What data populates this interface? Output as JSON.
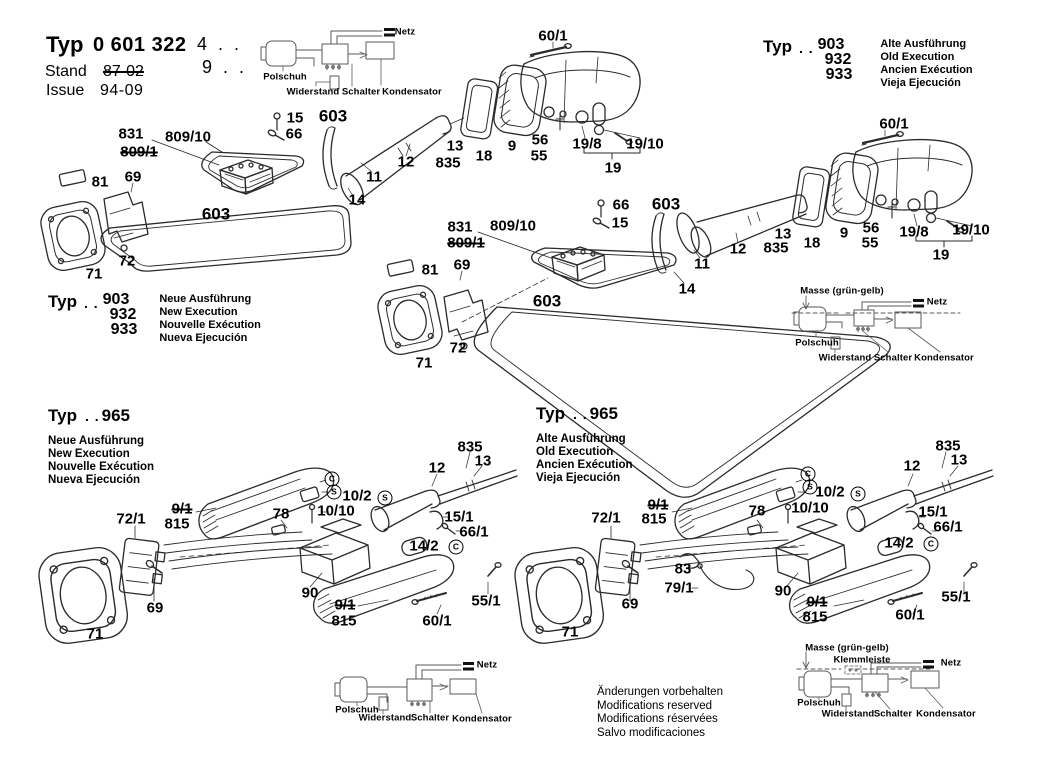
{
  "header": {
    "typ": "Typ",
    "number": "0 601 322",
    "suffix1": "4 . .",
    "suffix2": "9 . .",
    "stand_label": "Stand",
    "stand_value": "87-02",
    "issue_label": "Issue",
    "issue_value": "94-09"
  },
  "type_blocks": [
    {
      "typ": "Typ",
      "dots": ". .",
      "models": [
        "903",
        "932",
        "933"
      ],
      "variants": [
        "Alte Ausführung",
        "Old Execution",
        "Ancien Exécution",
        "Vieja Ejecución"
      ]
    },
    {
      "typ": "Typ",
      "dots": ". .",
      "models": [
        "903",
        "932",
        "933"
      ],
      "variants": [
        "Neue Ausführung",
        "New Execution",
        "Nouvelle Exécution",
        "Nueva Ejecución"
      ]
    },
    {
      "typ": "Typ",
      "dots": ". .",
      "models": [
        "965"
      ],
      "variants": [
        "Neue Ausführung",
        "New Execution",
        "Nouvelle Exécution",
        "Nueva Ejecución"
      ]
    },
    {
      "typ": "Typ",
      "dots": ". .",
      "models": [
        "965"
      ],
      "variants": [
        "Alte Ausführung",
        "Old Execution",
        "Ancien Exécution",
        "Vieja Ejecución"
      ]
    }
  ],
  "footer": {
    "lines": [
      "Änderungen vorbehalten",
      "Modifications reserved",
      "Modifications réservées",
      "Salvo modificaciones"
    ]
  },
  "colors": {
    "ink": "#000000",
    "line": "#2a2a2a",
    "schematic": "#5a5a5a",
    "paper": "#ffffff"
  },
  "labels": [
    {
      "t": "831",
      "x": 131,
      "y": 134
    },
    {
      "t": "809/1",
      "x": 139,
      "y": 152,
      "strike": 1
    },
    {
      "t": "809/10",
      "x": 188,
      "y": 137
    },
    {
      "t": "15",
      "x": 295,
      "y": 118
    },
    {
      "t": "66",
      "x": 294,
      "y": 134
    },
    {
      "t": "603",
      "x": 333,
      "y": 116,
      "lg": 1
    },
    {
      "t": "81",
      "x": 100,
      "y": 182
    },
    {
      "t": "69",
      "x": 133,
      "y": 177
    },
    {
      "t": "603",
      "x": 216,
      "y": 214,
      "lg": 1
    },
    {
      "t": "72",
      "x": 127,
      "y": 261
    },
    {
      "t": "71",
      "x": 94,
      "y": 274
    },
    {
      "t": "11",
      "x": 374,
      "y": 177
    },
    {
      "t": "14",
      "x": 357,
      "y": 200
    },
    {
      "t": "12",
      "x": 406,
      "y": 162
    },
    {
      "t": "13",
      "x": 455,
      "y": 146
    },
    {
      "t": "835",
      "x": 448,
      "y": 163
    },
    {
      "t": "18",
      "x": 484,
      "y": 156
    },
    {
      "t": "9",
      "x": 512,
      "y": 146
    },
    {
      "t": "56",
      "x": 540,
      "y": 140
    },
    {
      "t": "55",
      "x": 539,
      "y": 156
    },
    {
      "t": "19/8",
      "x": 587,
      "y": 144
    },
    {
      "t": "19/10",
      "x": 645,
      "y": 144
    },
    {
      "t": "19",
      "x": 613,
      "y": 168
    },
    {
      "t": "60/1",
      "x": 553,
      "y": 36
    },
    {
      "t": "66",
      "x": 621,
      "y": 205
    },
    {
      "t": "15",
      "x": 620,
      "y": 223
    },
    {
      "t": "603",
      "x": 666,
      "y": 204,
      "lg": 1
    },
    {
      "t": "831",
      "x": 460,
      "y": 227
    },
    {
      "t": "809/1",
      "x": 466,
      "y": 243,
      "strike": 1
    },
    {
      "t": "809/10",
      "x": 513,
      "y": 226
    },
    {
      "t": "81",
      "x": 430,
      "y": 270
    },
    {
      "t": "69",
      "x": 462,
      "y": 265
    },
    {
      "t": "603",
      "x": 547,
      "y": 301,
      "lg": 1
    },
    {
      "t": "72",
      "x": 458,
      "y": 348
    },
    {
      "t": "71",
      "x": 424,
      "y": 363
    },
    {
      "t": "11",
      "x": 702,
      "y": 264
    },
    {
      "t": "14",
      "x": 687,
      "y": 289
    },
    {
      "t": "12",
      "x": 738,
      "y": 249
    },
    {
      "t": "13",
      "x": 783,
      "y": 234
    },
    {
      "t": "835",
      "x": 776,
      "y": 248
    },
    {
      "t": "18",
      "x": 812,
      "y": 243
    },
    {
      "t": "9",
      "x": 844,
      "y": 233
    },
    {
      "t": "56",
      "x": 871,
      "y": 228
    },
    {
      "t": "55",
      "x": 870,
      "y": 243
    },
    {
      "t": "19/8",
      "x": 914,
      "y": 232
    },
    {
      "t": "19/10",
      "x": 971,
      "y": 230
    },
    {
      "t": "19",
      "x": 941,
      "y": 255
    },
    {
      "t": "60/1",
      "x": 894,
      "y": 124
    },
    {
      "t": "72/1",
      "x": 131,
      "y": 519
    },
    {
      "t": "9/1",
      "x": 182,
      "y": 509,
      "strike": 1
    },
    {
      "t": "815",
      "x": 177,
      "y": 524
    },
    {
      "t": "78",
      "x": 281,
      "y": 514
    },
    {
      "t": "10/10",
      "x": 336,
      "y": 511
    },
    {
      "t": "10/2",
      "x": 357,
      "y": 496
    },
    {
      "t": "S",
      "x": 385,
      "y": 498,
      "circle": 1
    },
    {
      "t": "C",
      "x": 332,
      "y": 479,
      "circle": 1
    },
    {
      "t": "S",
      "x": 334,
      "y": 492,
      "circle": 1
    },
    {
      "t": "12",
      "x": 437,
      "y": 468
    },
    {
      "t": "835",
      "x": 470,
      "y": 447
    },
    {
      "t": "13",
      "x": 483,
      "y": 461
    },
    {
      "t": "15/1",
      "x": 459,
      "y": 517
    },
    {
      "t": "66/1",
      "x": 474,
      "y": 532
    },
    {
      "t": "14/2",
      "x": 424,
      "y": 546
    },
    {
      "t": "C",
      "x": 456,
      "y": 547,
      "circle": 1
    },
    {
      "t": "90",
      "x": 310,
      "y": 593
    },
    {
      "t": "9/1",
      "x": 345,
      "y": 605,
      "strike": 1
    },
    {
      "t": "815",
      "x": 344,
      "y": 621
    },
    {
      "t": "60/1",
      "x": 437,
      "y": 621
    },
    {
      "t": "55/1",
      "x": 486,
      "y": 601
    },
    {
      "t": "69",
      "x": 155,
      "y": 608
    },
    {
      "t": "71",
      "x": 95,
      "y": 634
    },
    {
      "t": "72/1",
      "x": 606,
      "y": 518
    },
    {
      "t": "9/1",
      "x": 658,
      "y": 505,
      "strike": 1
    },
    {
      "t": "815",
      "x": 654,
      "y": 519
    },
    {
      "t": "78",
      "x": 757,
      "y": 511
    },
    {
      "t": "10/10",
      "x": 810,
      "y": 508
    },
    {
      "t": "10/2",
      "x": 830,
      "y": 492
    },
    {
      "t": "S",
      "x": 858,
      "y": 494,
      "circle": 1
    },
    {
      "t": "C",
      "x": 808,
      "y": 474,
      "circle": 1
    },
    {
      "t": "S",
      "x": 810,
      "y": 487,
      "circle": 1
    },
    {
      "t": "12",
      "x": 912,
      "y": 466
    },
    {
      "t": "835",
      "x": 948,
      "y": 446
    },
    {
      "t": "13",
      "x": 959,
      "y": 460
    },
    {
      "t": "15/1",
      "x": 933,
      "y": 512
    },
    {
      "t": "66/1",
      "x": 948,
      "y": 527
    },
    {
      "t": "14/2",
      "x": 899,
      "y": 543
    },
    {
      "t": "C",
      "x": 931,
      "y": 544,
      "circle": 1
    },
    {
      "t": "83",
      "x": 683,
      "y": 569
    },
    {
      "t": "79/1",
      "x": 679,
      "y": 588
    },
    {
      "t": "90",
      "x": 783,
      "y": 591
    },
    {
      "t": "9/1",
      "x": 817,
      "y": 602,
      "strike": 1
    },
    {
      "t": "815",
      "x": 815,
      "y": 617
    },
    {
      "t": "60/1",
      "x": 910,
      "y": 615
    },
    {
      "t": "55/1",
      "x": 956,
      "y": 597
    },
    {
      "t": "69",
      "x": 630,
      "y": 604
    },
    {
      "t": "71",
      "x": 570,
      "y": 632
    },
    {
      "t": "Netz",
      "x": 405,
      "y": 32,
      "sm": 1
    },
    {
      "t": "Polschuh",
      "x": 285,
      "y": 77,
      "sm": 1
    },
    {
      "t": "Widerstand",
      "x": 313,
      "y": 92,
      "sm": 1
    },
    {
      "t": "Schalter",
      "x": 361,
      "y": 92,
      "sm": 1
    },
    {
      "t": "Kondensator",
      "x": 412,
      "y": 92,
      "sm": 1
    },
    {
      "t": "Masse (grün-gelb)",
      "x": 842,
      "y": 291,
      "sm": 1
    },
    {
      "t": "Netz",
      "x": 937,
      "y": 302,
      "sm": 1
    },
    {
      "t": "Polschuh",
      "x": 817,
      "y": 343,
      "sm": 1
    },
    {
      "t": "Widerstand",
      "x": 845,
      "y": 358,
      "sm": 1
    },
    {
      "t": "Schalter",
      "x": 893,
      "y": 358,
      "sm": 1
    },
    {
      "t": "Kondensator",
      "x": 944,
      "y": 358,
      "sm": 1
    },
    {
      "t": "Netz",
      "x": 487,
      "y": 665,
      "sm": 1
    },
    {
      "t": "Polschuh",
      "x": 357,
      "y": 710,
      "sm": 1
    },
    {
      "t": "Widerstand",
      "x": 385,
      "y": 718,
      "sm": 1
    },
    {
      "t": "Schalter",
      "x": 430,
      "y": 718,
      "sm": 1
    },
    {
      "t": "Kondensator",
      "x": 482,
      "y": 719,
      "sm": 1
    },
    {
      "t": "Masse (grün-gelb)",
      "x": 847,
      "y": 648,
      "sm": 1
    },
    {
      "t": "Klemmleiste",
      "x": 862,
      "y": 660,
      "sm": 1
    },
    {
      "t": "Netz",
      "x": 951,
      "y": 663,
      "sm": 1
    },
    {
      "t": "Polschuh",
      "x": 819,
      "y": 703,
      "sm": 1
    },
    {
      "t": "Widerstand",
      "x": 848,
      "y": 714,
      "sm": 1
    },
    {
      "t": "Schalter",
      "x": 893,
      "y": 714,
      "sm": 1
    },
    {
      "t": "Kondensator",
      "x": 946,
      "y": 714,
      "sm": 1
    }
  ]
}
